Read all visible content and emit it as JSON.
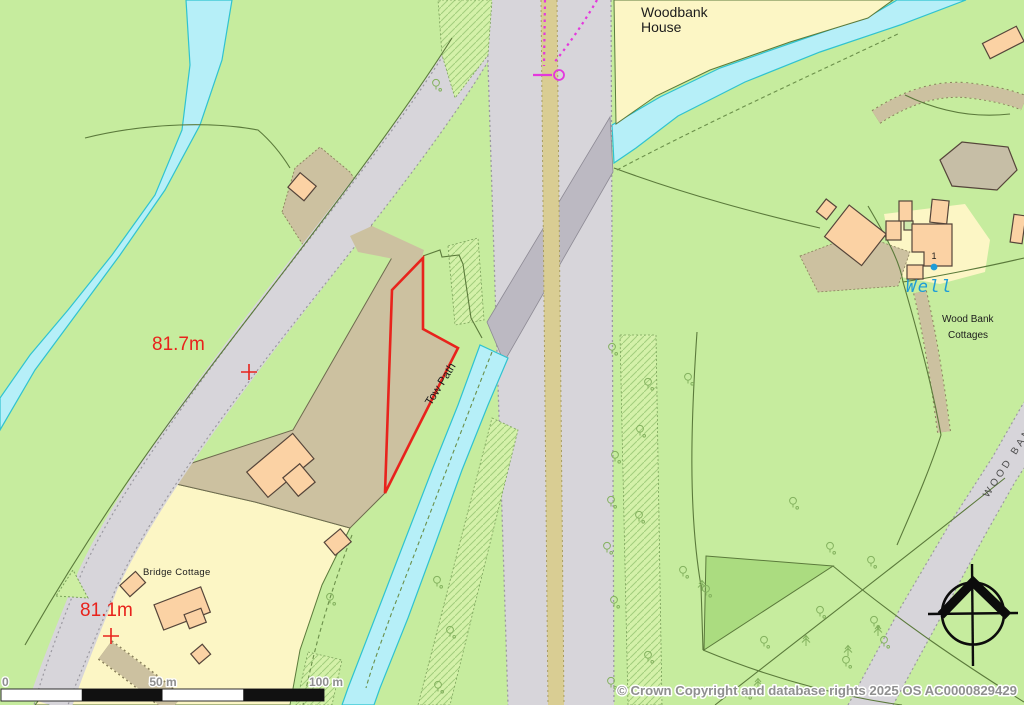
{
  "map": {
    "place_labels": {
      "woodbank_house": {
        "line1": "Woodbank",
        "line2": "House"
      },
      "bridge_cottage": "Bridge Cottage",
      "wood_bank_cottages": {
        "line1": "Wood Bank",
        "line2": "Cottages"
      },
      "well": "Well",
      "tow_path": "Tow Path",
      "road_name": "WOOD BANK",
      "house_number": "1"
    },
    "spot_heights": {
      "upper": "81.7m",
      "lower": "81.1m"
    },
    "scale_bar": {
      "zero": "0",
      "fifty": "50 m",
      "hundred": "100 m"
    },
    "copyright": "© Crown Copyright and database rights 2025 OS AC0000829429",
    "colors": {
      "field_green": "#c6ec9e",
      "hatch_green": "#d4f1a9",
      "dark_green_wedge": "#abdc80",
      "water_fill": "#b6eff8",
      "water_edge": "#2fc3d0",
      "road_gray": "#d7d5da",
      "bridge_gray": "#bcb9c2",
      "median_tan": "#d9cd93",
      "track_tan": "#ccc1a0",
      "grounds_yellow": "#fcf6c5",
      "building_fill": "#fbd2a4",
      "building_outline": "#55453a",
      "parcel_red": "#e8231c",
      "boundary_magenta": "#e438dd",
      "well_blue": "#1e9cd8",
      "boundary_green": "#5b7a3b",
      "label_gray": "#8f8f8f"
    }
  }
}
